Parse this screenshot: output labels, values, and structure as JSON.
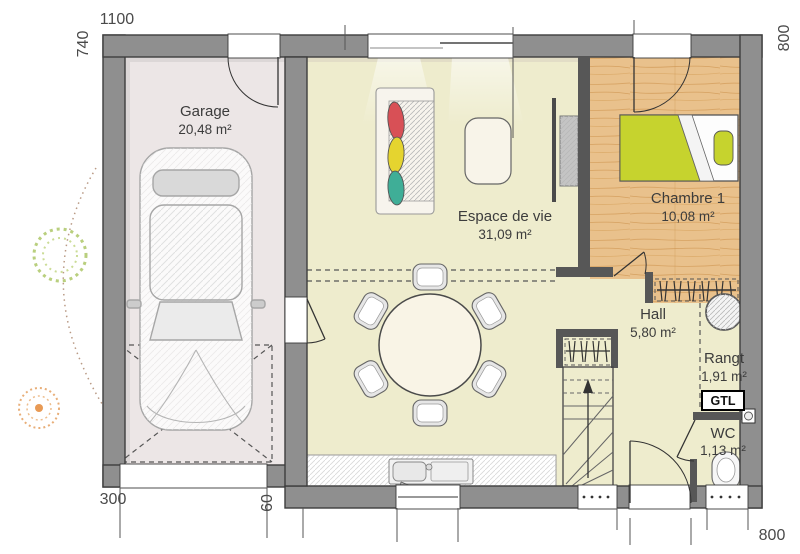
{
  "plan_title": "floor-plan-ground-level",
  "rooms": {
    "garage": {
      "name": "Garage",
      "area": "20,48 m²"
    },
    "living": {
      "name": "Espace de vie",
      "area": "31,09 m²"
    },
    "bedroom": {
      "name": "Chambre 1",
      "area": "10,08 m²"
    },
    "hall": {
      "name": "Hall",
      "area": "5,80 m²"
    },
    "storage": {
      "name": "Rangt",
      "area": "1,91 m²"
    },
    "wc": {
      "name": "WC",
      "area": "1,13 m²"
    }
  },
  "labels": {
    "gtl": "GTL"
  },
  "dimensions": {
    "top_width": "1100",
    "left_height": "740",
    "right_height": "800",
    "garage_door_width": "300",
    "door_offset": "60",
    "bottom_right_width": "800"
  },
  "colors": {
    "wall_fill": "#8f8f8f",
    "wall_outline": "#3d3d3d",
    "partition_fill": "#575757",
    "garage_floor": "#ece6e6",
    "living_floor": "#eeeccd",
    "wood_floor": "#e9c18c",
    "bed_duvet": "#c6d32e",
    "cushion_red": "#d85056",
    "cushion_yellow": "#e5d42f",
    "cushion_teal": "#3fae97",
    "dimension_text": "#4a4a4a",
    "room_text": "#3c3c3c"
  }
}
